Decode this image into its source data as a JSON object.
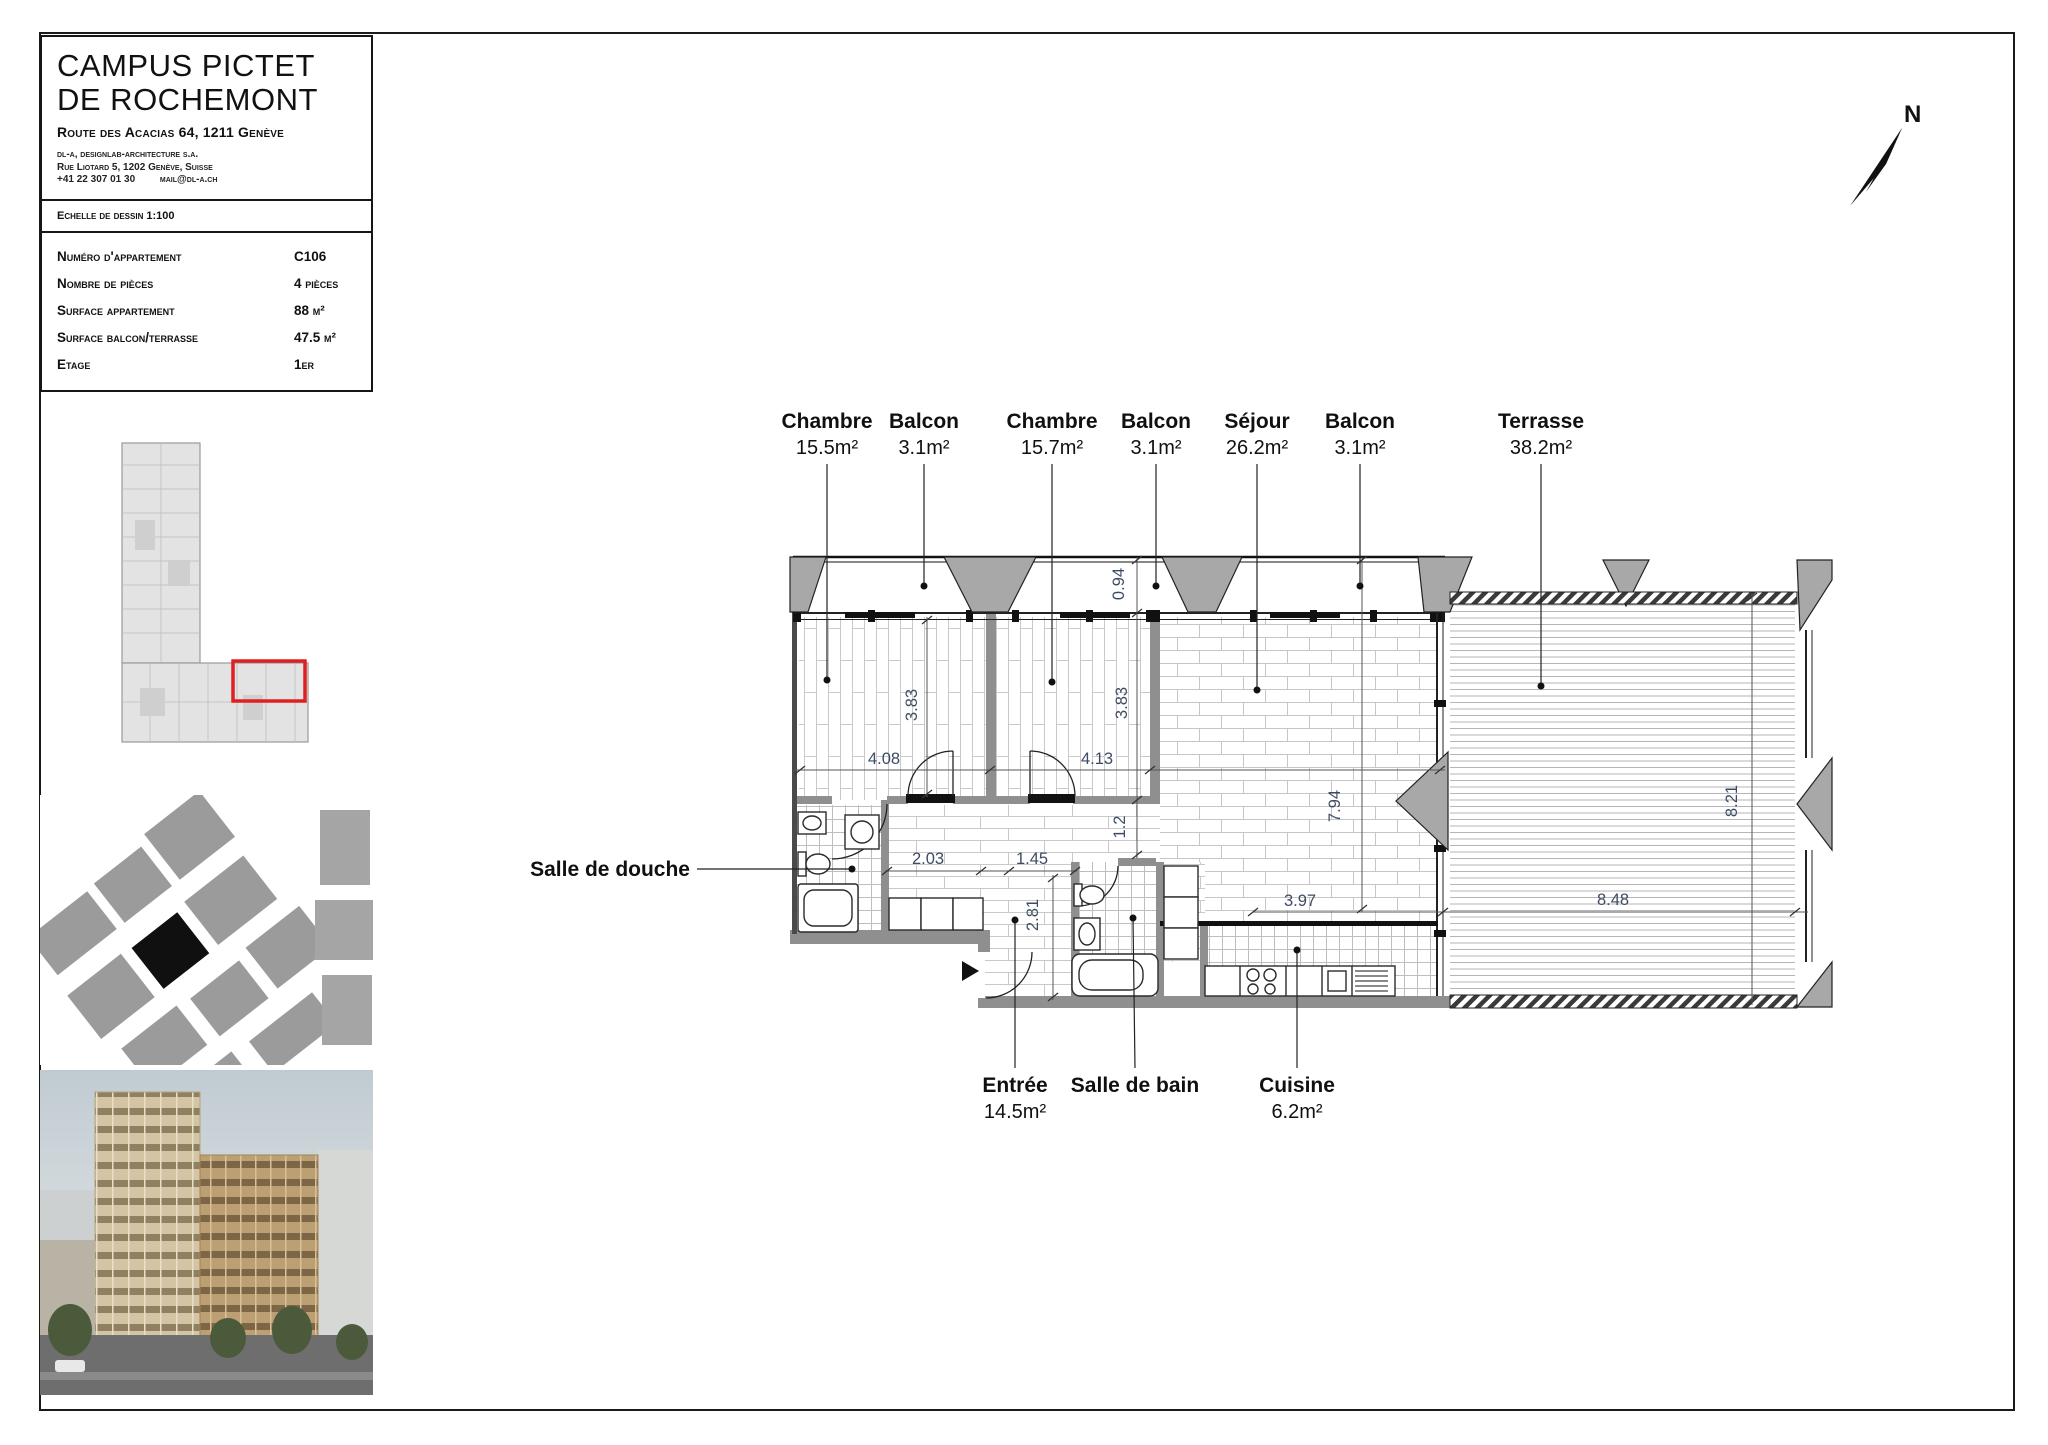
{
  "sheet": {
    "project": {
      "title_line1": "CAMPUS PICTET",
      "title_line2": "DE ROCHEMONT",
      "address": "Route des Acacias 64, 1211 Genève",
      "architect_name": "dl-a, designlab-architecture s.a.",
      "architect_address": "Rue Liotard 5, 1202 Genève, Suisse",
      "architect_phone": "+41 22 307 01 30",
      "architect_email": "mail@dl-a.ch",
      "scale_note": "Echelle de dessin 1:100"
    },
    "apartment_info": {
      "rows": [
        {
          "label": "Numéro d'appartement",
          "value": "C106"
        },
        {
          "label": "Nombre de pièces",
          "value": "4 pièces"
        },
        {
          "label": "Surface appartement",
          "value": "88 m²"
        },
        {
          "label": "Surface balcon/terrasse",
          "value": "47.5 m²"
        },
        {
          "label": "Etage",
          "value": "1er"
        }
      ]
    }
  },
  "plan": {
    "north_label": "N",
    "rooms_top": [
      {
        "name": "Chambre",
        "area": "15.5m²"
      },
      {
        "name": "Balcon",
        "area": "3.1m²"
      },
      {
        "name": "Chambre",
        "area": "15.7m²"
      },
      {
        "name": "Balcon",
        "area": "3.1m²"
      },
      {
        "name": "Séjour",
        "area": "26.2m²"
      },
      {
        "name": "Balcon",
        "area": "3.1m²"
      },
      {
        "name": "Terrasse",
        "area": "38.2m²"
      }
    ],
    "rooms_bottom": [
      {
        "name": "Entrée",
        "area": "14.5m²"
      },
      {
        "name": "Salle de bain",
        "area": ""
      },
      {
        "name": "Cuisine",
        "area": "6.2m²"
      }
    ],
    "room_left": {
      "name": "Salle de douche"
    },
    "dims": {
      "chambre1_depth": "3.83",
      "chambre1_width": "4.08",
      "chambre2_depth": "3.83",
      "chambre2_width": "4.13",
      "balcon_depth": "0.94",
      "couloir_width": "1.2",
      "couloir_seg1": "2.03",
      "couloir_seg2": "1.45",
      "entree_depth": "2.81",
      "sejour_depth": "7.94",
      "cuisine_width": "3.97",
      "terrasse_width": "8.48",
      "terrasse_depth": "8.21"
    },
    "colors": {
      "highlight_red": "#e02020",
      "wall_gray": "#8f8f8f",
      "wedge_gray": "#a8a8a8",
      "dim_text": "#3e4c63"
    }
  }
}
